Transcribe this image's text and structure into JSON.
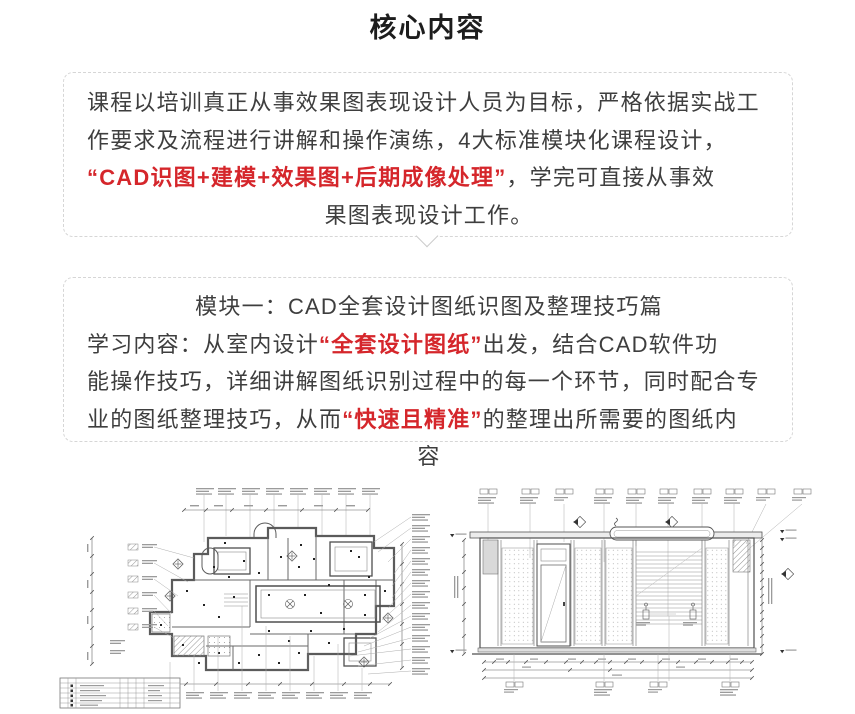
{
  "title": "核心内容",
  "colors": {
    "body_text": "#3e3e3e",
    "accent_red": "#d5262b",
    "box_border": "#d6d6d6",
    "drawing_line": "#4a4a4a"
  },
  "intro_box": {
    "line1": "课程以培训真正从事效果图表现设计人员为目标，严格依据实战工",
    "line2": "作要求及流程进行讲解和操作演练，4大标准模块化课程设计，",
    "line3_red": "“CAD识图+建模+效果图+后期成像处理”",
    "line3_rest": "，学完可直接从事效",
    "line4": "果图表现设计工作。"
  },
  "module_box": {
    "heading": "模块一：CAD全套设计图纸识图及整理技巧篇",
    "line2_pre": "学习内容：从室内设计",
    "line2_red": "“全套设计图纸”",
    "line2_post": "出发，结合CAD软件功",
    "line3": "能操作技巧，详细讲解图纸识别过程中的每一个环节，同时配合专",
    "line4_pre": "业的图纸整理技巧，从而",
    "line4_red": "“快速且精准”",
    "line4_post": "的整理出所需要的图纸内",
    "line5": "容"
  }
}
